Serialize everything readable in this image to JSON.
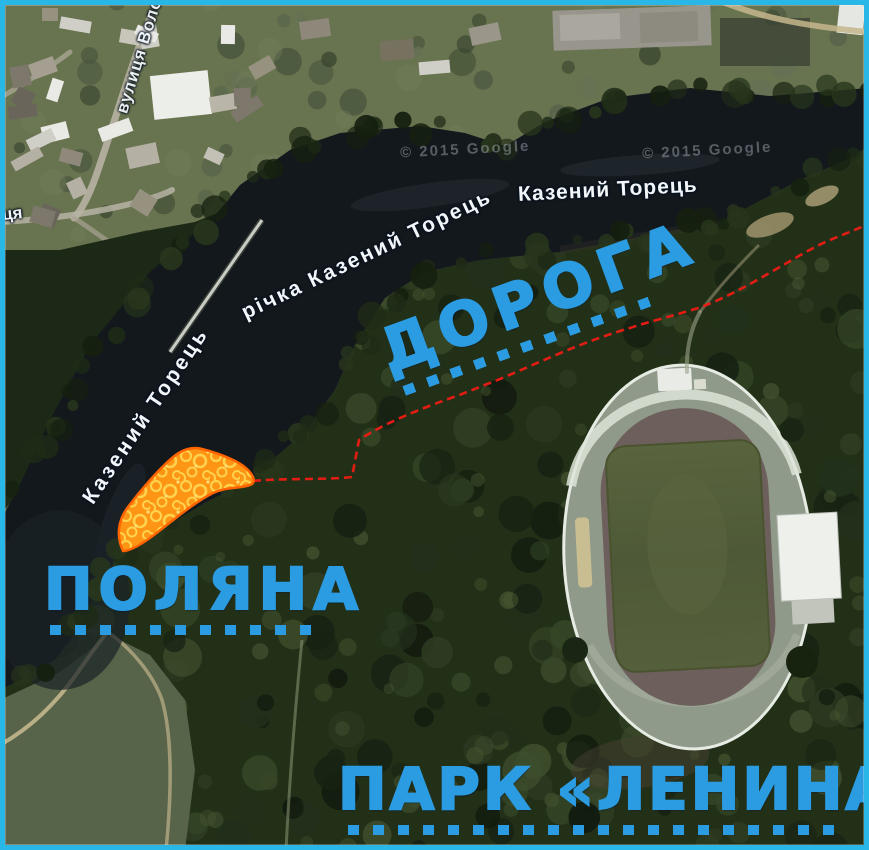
{
  "colors": {
    "frame": "#29b7e8",
    "annotation-blue": "#2b9ce2",
    "route-red": "#ee1b14",
    "glade-fill": "#ff9514",
    "glade-ring": "#ffd34d",
    "glade-border": "#ff6400"
  },
  "map_labels": {
    "street_top": "вулиця Воло",
    "street_fragment": "ця",
    "river_name_full": "річка Казений Торець",
    "river_name_diagonal": "Казений Торець",
    "river_name_horizontal": "Казений Торець",
    "copyright": "© 2015 Google"
  },
  "annotations": {
    "road": "ДОРОГА",
    "glade": "ПОЛЯНА",
    "park": "ПАРК «ЛЕНИНА»"
  }
}
